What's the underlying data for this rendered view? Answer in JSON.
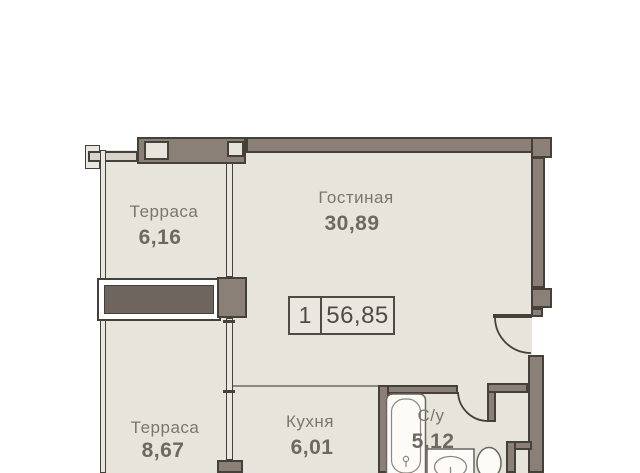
{
  "floorplan": {
    "badge": {
      "rooms_count": "1",
      "total_area": "56,85"
    },
    "rooms": [
      {
        "name": "terrace-upper",
        "label": "Терраса",
        "area": "6,16"
      },
      {
        "name": "living-room",
        "label": "Гостиная",
        "area": "30,89"
      },
      {
        "name": "terrace-lower",
        "label": "Терраса",
        "area": "8,67"
      },
      {
        "name": "kitchen",
        "label": "Кухня",
        "area": "6,01"
      },
      {
        "name": "bathroom",
        "label": "С/у",
        "area": "5,12"
      }
    ],
    "fixtures": [
      "bathtub",
      "sink",
      "toilet"
    ],
    "colors": {
      "background": "#ffffff",
      "floor": "#e6e4db",
      "wall": "#8a8078",
      "wall_outline": "#45403a",
      "planter": "#6e655e",
      "label_text": "#7b766d",
      "badge_text": "#4f4b44"
    }
  }
}
